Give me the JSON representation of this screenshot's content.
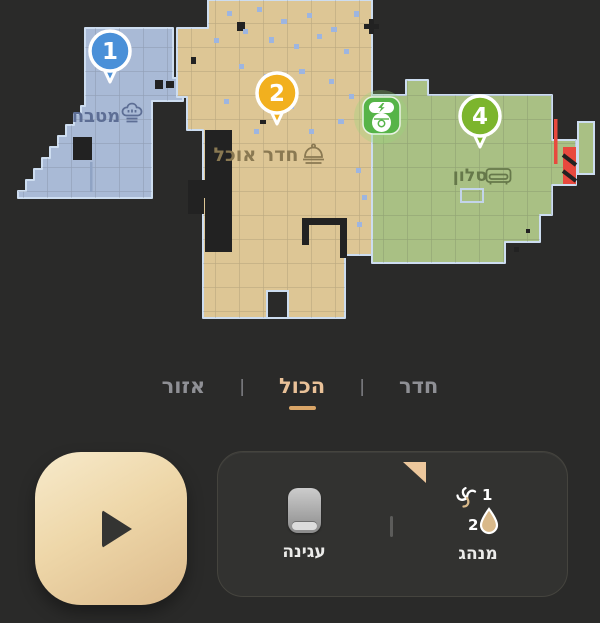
{
  "map": {
    "rooms": [
      {
        "number": "1",
        "name": "מטבח",
        "type": "kitchen",
        "marker_color": "#4a90d8",
        "fill": "#a9bad6",
        "label_color": "#5d6e95"
      },
      {
        "number": "2",
        "name": "חדר אוכל",
        "type": "dining-room",
        "marker_color": "#f2b01e",
        "fill": "#ddc695",
        "label_color": "#8a7952"
      },
      {
        "number": "4",
        "name": "סלון",
        "type": "living-room",
        "marker_color": "#7cb52d",
        "fill": "#a9c084",
        "label_color": "#66784a"
      }
    ],
    "robot": {
      "state": "docked-charging",
      "dock_color": "#56b448",
      "glow_color": "#8fd078"
    },
    "restriction_color": "#e8493e",
    "wall_outline_color": "#cdddf0"
  },
  "tabs": {
    "items": [
      {
        "label": "חדר",
        "selected": false
      },
      {
        "label": "הכול",
        "selected": true
      },
      {
        "label": "אזור",
        "selected": false
      }
    ],
    "separator": "|",
    "selected_color": "#e9c198",
    "underline_color": "#d9a567"
  },
  "controls": {
    "dock_label": "עגינה",
    "mode_label": "מנהג",
    "fan_level": "1",
    "water_level": "2"
  },
  "icons": {
    "play-icon": "triangle-right",
    "chef-hat-icon": "toque",
    "cloche-icon": "serving-dome",
    "couch-icon": "sofa",
    "dock-icon": "charging-dock",
    "fan-icon": "fan-swirl",
    "water-drop-icon": "droplet",
    "robot-dock-icon": "robot-on-charger",
    "virtual-wall-icon": "red-line",
    "no-go-zone-icon": "red-striped-box"
  },
  "colors": {
    "background": "#2a2a29",
    "panel": "#32322f",
    "play_button": "#eed7a9",
    "obstacle": "#222222",
    "scatter_dot": "#9db5e0"
  }
}
